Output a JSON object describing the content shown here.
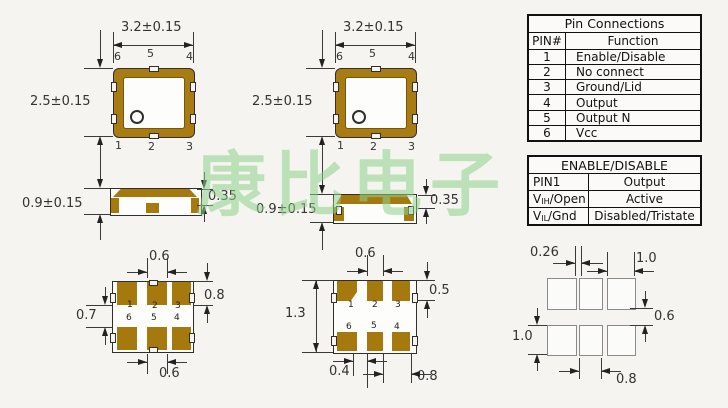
{
  "watermark": {
    "text": "康比电子",
    "color": "#8FD28B"
  },
  "colors": {
    "package_body": "#A87C12",
    "pad_brown": "#A5790E",
    "background": "#F5F4F0"
  },
  "top_view_1": {
    "dim_width": "3.2±0.15",
    "dim_height": "2.5±0.15",
    "pins_top": [
      "6",
      "5",
      "4"
    ],
    "pins_bottom": [
      "1",
      "2",
      "3"
    ]
  },
  "top_view_2": {
    "dim_width": "3.2±0.15",
    "dim_height": "2.5±0.15",
    "pins_top": [
      "6",
      "5",
      "4"
    ],
    "pins_bottom": [
      "1",
      "2",
      "3"
    ]
  },
  "side_view_1": {
    "dim_height": "0.9±0.15",
    "dim_lid": "0.35"
  },
  "side_view_2": {
    "dim_height": "0.9±0.15",
    "dim_lid": "0.35"
  },
  "land_pattern_1": {
    "dim_top": "0.6",
    "dim_right": "0.8",
    "dim_left": "0.7",
    "dim_bottom": "0.6",
    "pins_row1": [
      "1",
      "2",
      "3"
    ],
    "pins_row2": [
      "6",
      "5",
      "4"
    ]
  },
  "land_pattern_2": {
    "dim_top": "0.6",
    "dim_right": "0.5",
    "dim_left": "1.3",
    "dim_bottom_left": "0.4",
    "dim_bottom_right": "0.8",
    "pins_row1": [
      "1",
      "2",
      "3"
    ],
    "pins_row2": [
      "6",
      "5",
      "4"
    ]
  },
  "solder_pattern": {
    "dim_top_left": "0.26",
    "dim_top_right": "1.0",
    "dim_right": "0.6",
    "dim_left": "1.0",
    "dim_bottom": "0.8"
  },
  "pin_connections": {
    "title": "Pin Connections",
    "headers": [
      "PIN#",
      "Function"
    ],
    "rows": [
      [
        "1",
        "Enable/Disable"
      ],
      [
        "2",
        "No connect"
      ],
      [
        "3",
        "Ground/Lid"
      ],
      [
        "4",
        "Output"
      ],
      [
        "5",
        "Output N"
      ],
      [
        "6",
        "Vcc"
      ]
    ]
  },
  "enable_disable": {
    "title": "ENABLE/DISABLE",
    "rows": [
      {
        "pin_main": "PIN1",
        "pin_sub": "",
        "pin_rest": "",
        "state": "Output"
      },
      {
        "pin_main": "V",
        "pin_sub": "IH",
        "pin_rest": "/Open",
        "state": "Active"
      },
      {
        "pin_main": "V",
        "pin_sub": "IL",
        "pin_rest": "/Gnd",
        "state": "Disabled/Tristate"
      }
    ]
  }
}
